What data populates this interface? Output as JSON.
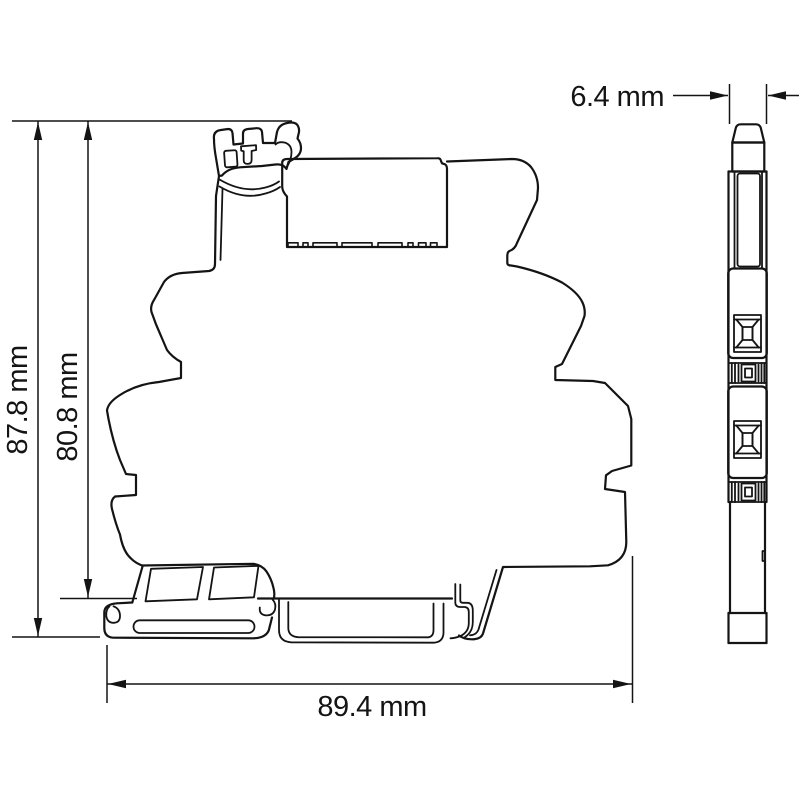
{
  "canvas": {
    "background": "#ffffff",
    "line_color": "#141414",
    "content": "technical dimension drawing of DIN-rail relay module, side profile and front profile"
  },
  "dimension_labels": {
    "total_height": "87.8 mm",
    "mounting_height": "80.8 mm",
    "total_width": "89.4 mm",
    "depth": "6.4 mm"
  },
  "icons": {
    "arrowhead": "filled-triangle"
  }
}
